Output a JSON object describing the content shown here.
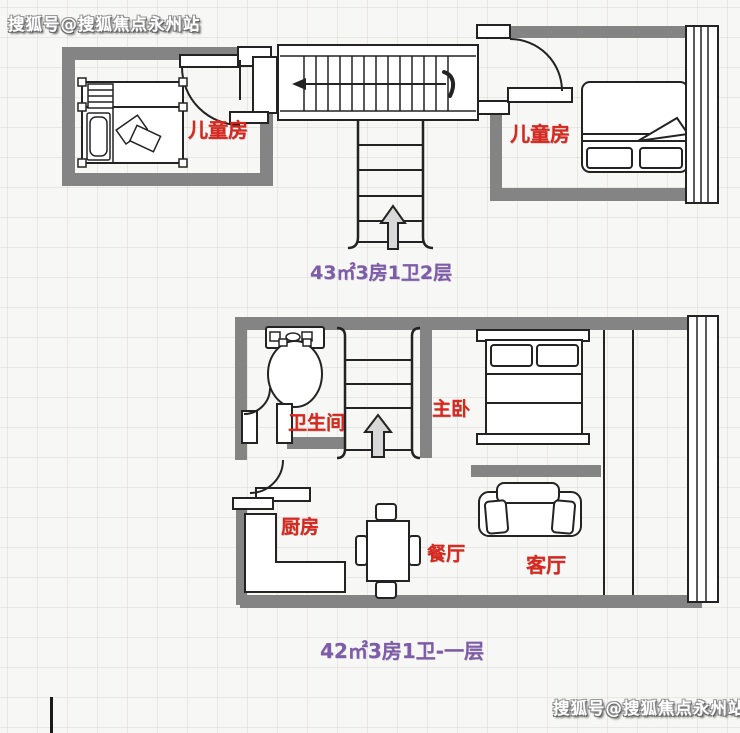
{
  "watermarks": {
    "top_left": "搜狐号@搜狐焦点永州站",
    "bottom_right": "搜狐号@搜狐焦点永州站"
  },
  "floor_plans": {
    "upper": {
      "caption": "43㎡3房1卫2层",
      "rooms": {
        "left_child": "儿童房",
        "right_child": "儿童房"
      }
    },
    "lower": {
      "caption": "42㎡3房1卫-一层",
      "rooms": {
        "bathroom": "卫生间",
        "master_bedroom": "主卧",
        "kitchen": "厨房",
        "dining": "餐厅",
        "living": "客厅"
      }
    }
  },
  "colors": {
    "wall": "#848484",
    "label": "#d7271e",
    "caption": "#7d5ca8",
    "arrow": "#d8d8d8",
    "line": "#232323"
  }
}
